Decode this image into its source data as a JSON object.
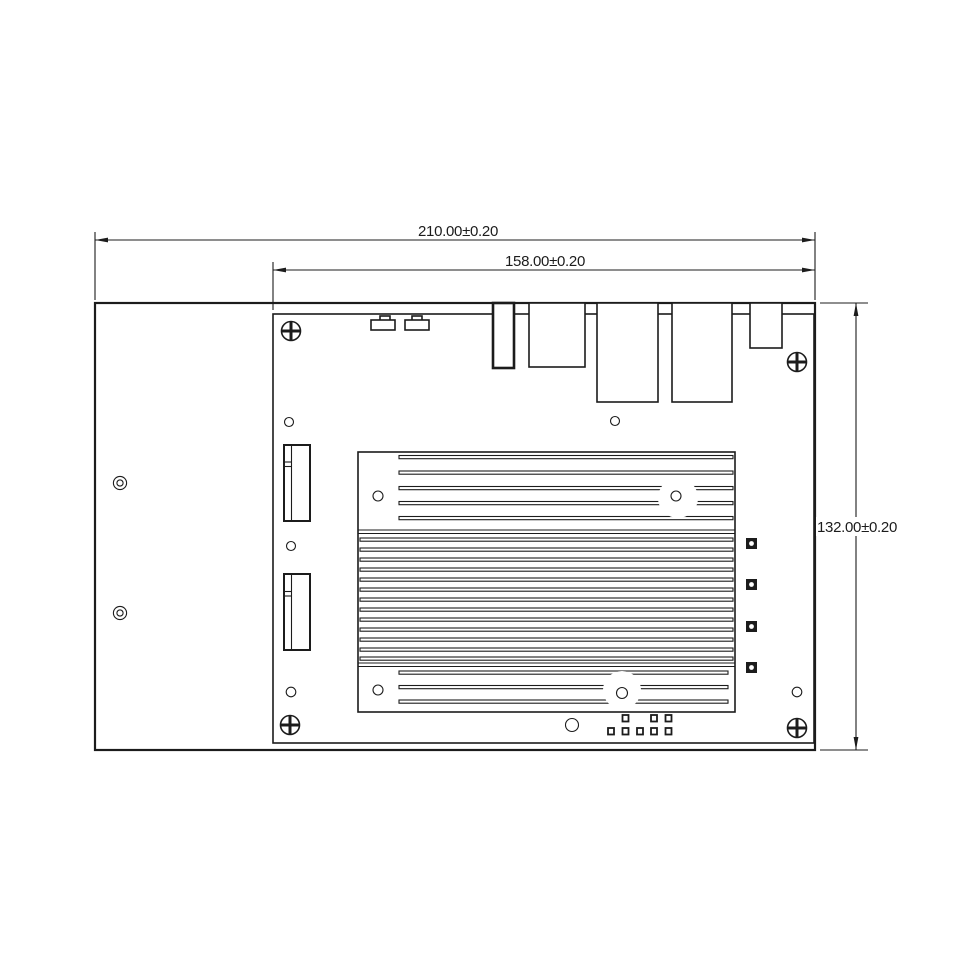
{
  "page": {
    "background_color": "#ffffff",
    "line_color": "#1c1c1c"
  },
  "drawing": {
    "type": "mechanical-dimension-drawing",
    "subject": "embedded-board-on-mounting-plate-top-view",
    "dimensions": {
      "overall_width_label": "210.00±0.20",
      "board_width_label": "158.00±0.20",
      "overall_height_label": "132.00±0.20"
    }
  }
}
